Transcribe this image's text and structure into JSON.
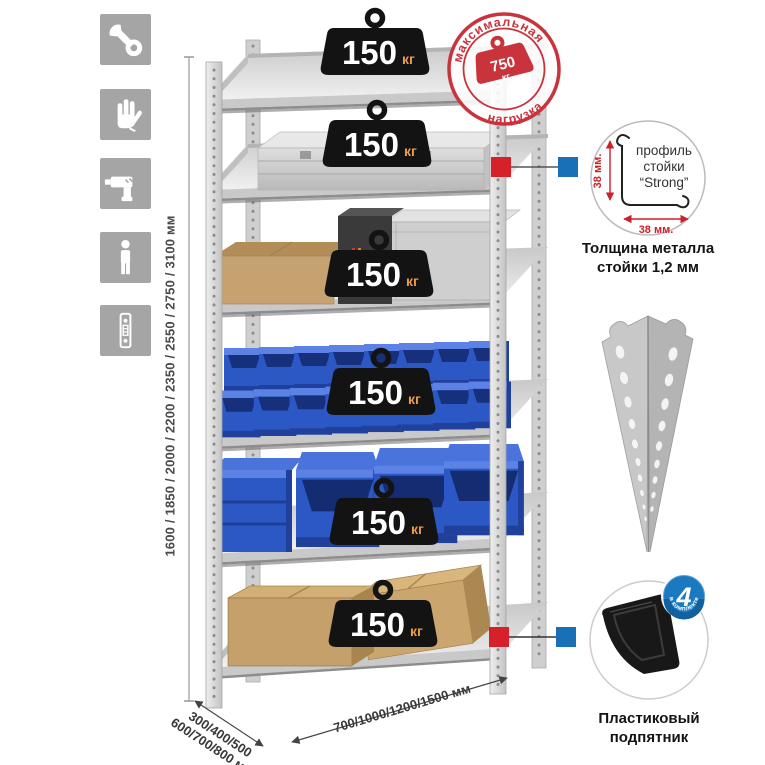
{
  "left_icons": [
    {
      "name": "wrench"
    },
    {
      "name": "gloves"
    },
    {
      "name": "drill"
    },
    {
      "name": "person"
    },
    {
      "name": "perforated-strip"
    }
  ],
  "dimensions": {
    "height": "1600 / 1850 / 2000 / 2200 / 2350 / 2550 / 2750 / 3100 мм",
    "depth_line1": "300/400/500",
    "depth_line2": "600/700/800 мм",
    "width": "700/1000/1200/1500 мм"
  },
  "shelf_load": {
    "value": "150",
    "unit": "кг"
  },
  "max_load_stamp": {
    "arc_top": "максимальная",
    "arc_bottom": "нагрузка",
    "value": "750",
    "unit": "кг"
  },
  "profile_detail": {
    "label_line1": "профиль",
    "label_line2": "стойки",
    "label_line3": "“Strong”",
    "dim_vertical": "38 мм.",
    "dim_horizontal": "38 мм.",
    "caption_line1": "Толщина металла",
    "caption_line2": "стойки 1,2 мм"
  },
  "foot_detail": {
    "badge_value": "4",
    "badge_arc": "в комплекте",
    "caption_line1": "Пластиковый",
    "caption_line2": "подпятник"
  },
  "colors": {
    "accent_red": "#c8333c",
    "marker_red": "#d6202a",
    "marker_blue": "#1a70b6",
    "badge_blue": "#1b79c0",
    "bin_blue": "#2c58c5",
    "icon_gray": "#a5a5a5"
  }
}
